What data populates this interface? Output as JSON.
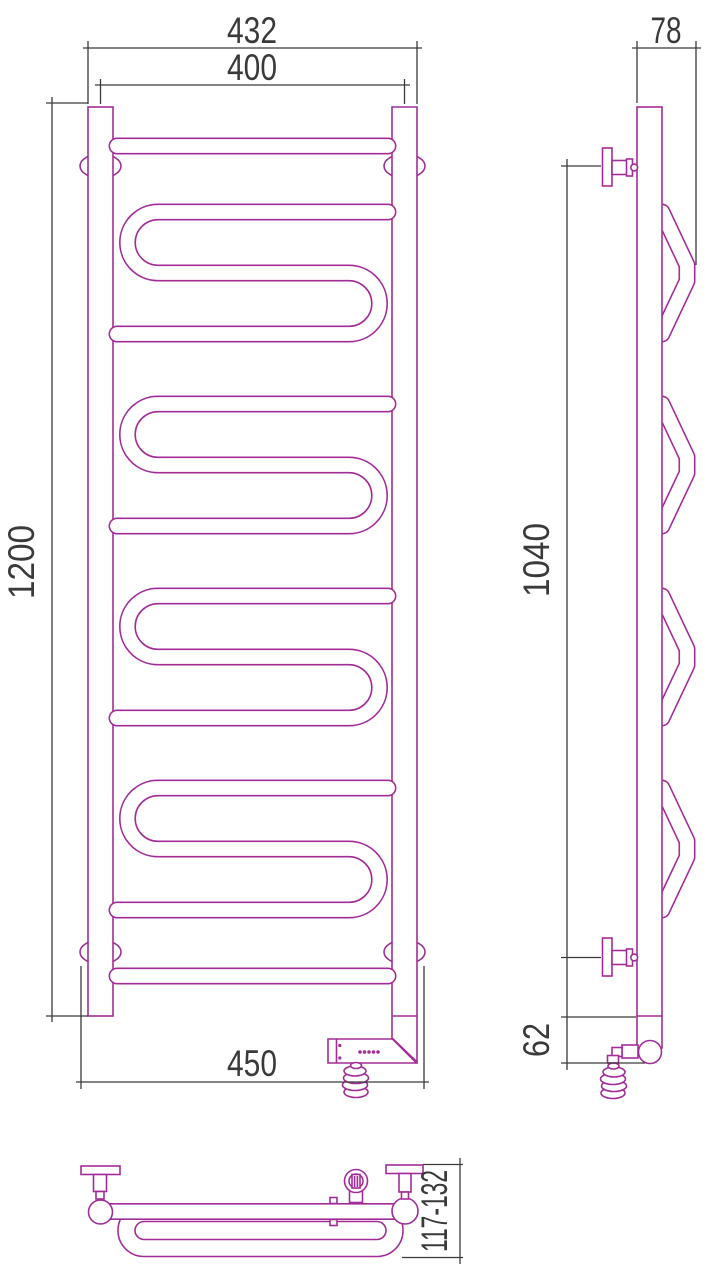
{
  "drawing": {
    "type": "technical-drawing",
    "subject": "heated towel rail (ladder radiator with serpentine coils and electric heating element), three orthographic views",
    "colors": {
      "product_outline": "#a32d98",
      "dimension_lines": "#3a3a3a",
      "background": "#ffffff"
    },
    "views": {
      "front": {
        "label": "front view",
        "dimensions": {
          "overall_width": "432",
          "axis_width": "400",
          "height": "1200",
          "overall_width_with_brackets": "450"
        }
      },
      "side": {
        "label": "side view",
        "dimensions": {
          "depth": "78",
          "bracket_span": "1040",
          "bottom_offset": "62"
        }
      },
      "plan": {
        "label": "plan view",
        "dimensions": {
          "wall_clearance": "117-132"
        }
      }
    }
  }
}
